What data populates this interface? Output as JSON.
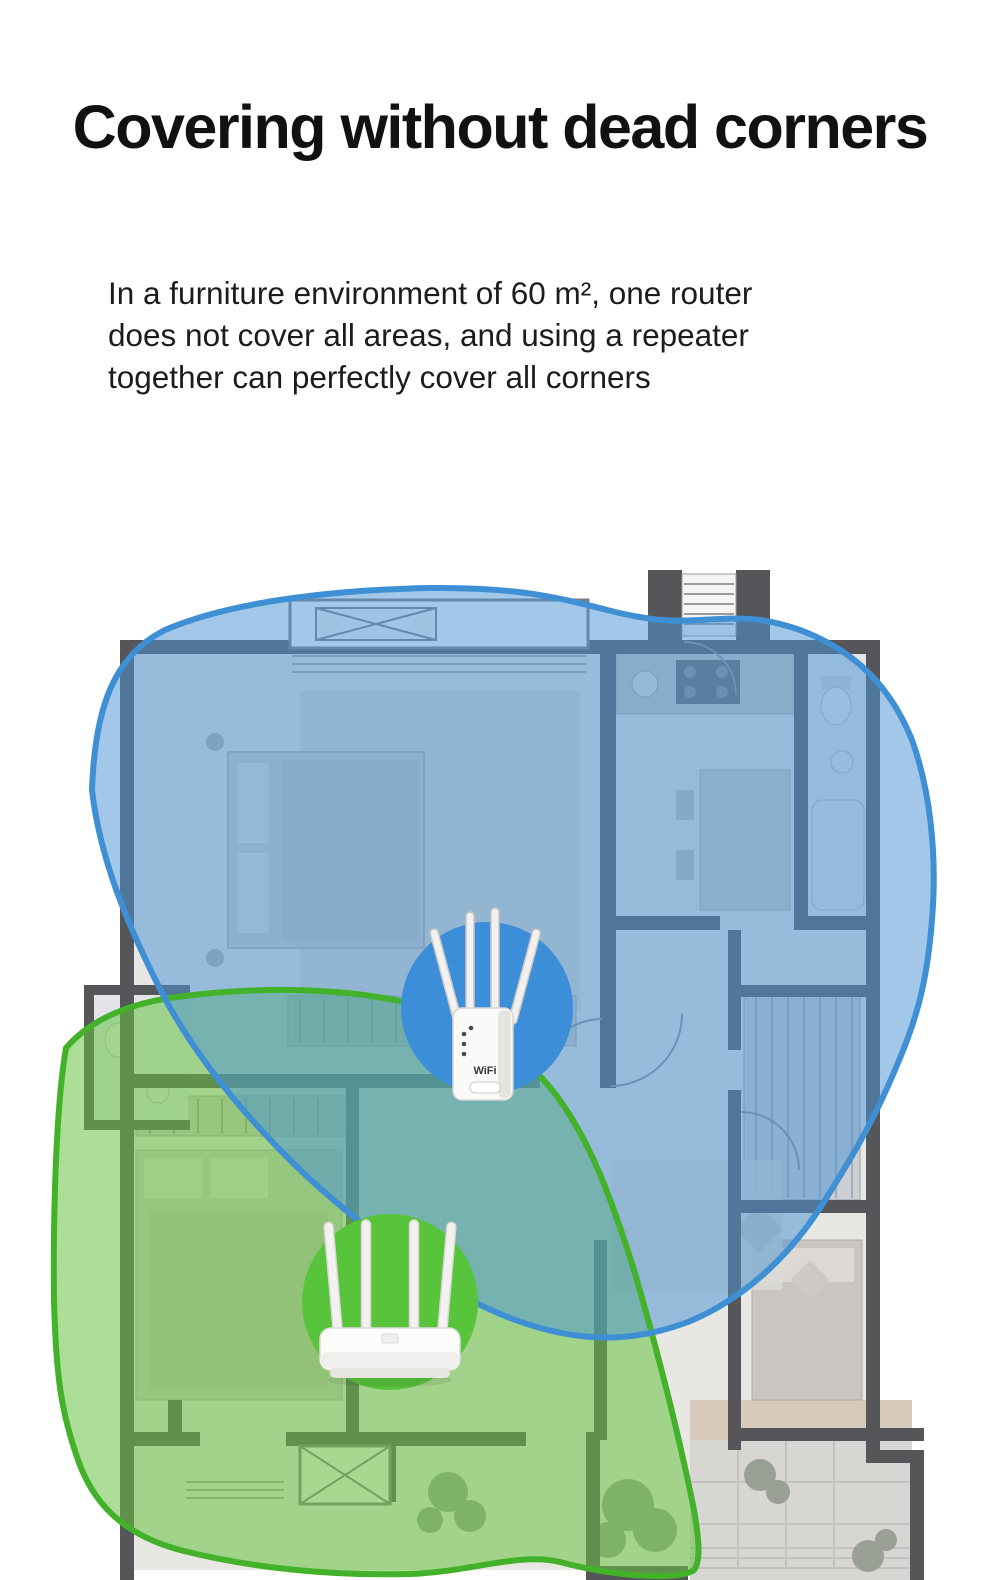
{
  "header": {
    "title": "Covering without dead corners",
    "description_lines": [
      "In a furniture environment of 60 m², one router",
      "does not cover all areas, and using a repeater",
      "together can perfectly cover all corners"
    ]
  },
  "scene": {
    "repeater_coverage": {
      "fill": "rgba(77,148,210,0.52)",
      "stroke": "#3e8fd4"
    },
    "router_coverage": {
      "fill": "rgba(104,194,66,0.55)",
      "stroke": "#43b22a"
    },
    "repeater_marker_color": "#3d8ed9",
    "router_marker_color": "#58c43c",
    "devices": {
      "repeater": {
        "label": "WiFi repeater",
        "logo": "WiFi"
      },
      "router": {
        "label": "Wireless router"
      }
    }
  }
}
